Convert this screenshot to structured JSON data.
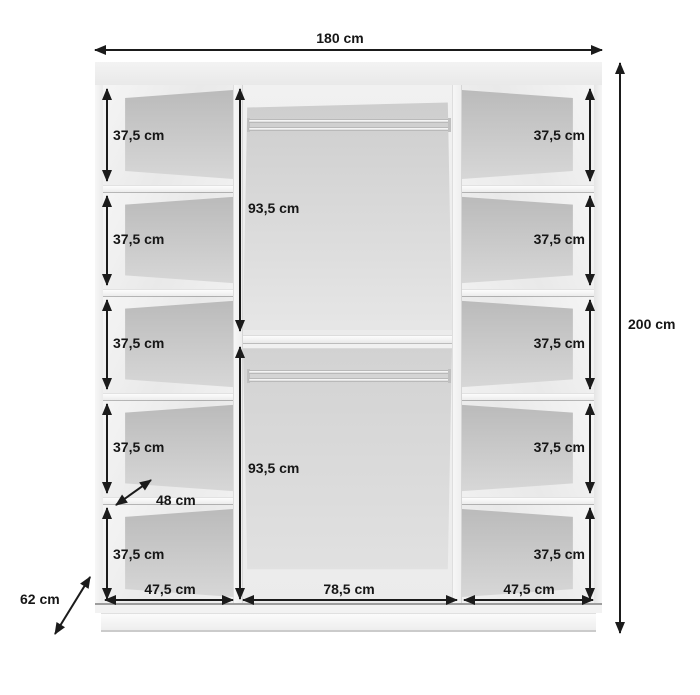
{
  "diagram": {
    "type": "furniture-dimension-drawing",
    "subject": "wardrobe interior with shelves and hanging rails",
    "unit": "cm",
    "overall": {
      "width": "180 cm",
      "height": "200 cm",
      "depth": "62 cm"
    },
    "shelf_depth": "48 cm",
    "left_column_shelves": [
      "37,5 cm",
      "37,5 cm",
      "37,5 cm",
      "37,5 cm",
      "37,5 cm"
    ],
    "right_column_shelves": [
      "37,5 cm",
      "37,5 cm",
      "37,5 cm",
      "37,5 cm",
      "37,5 cm"
    ],
    "hanging_sections": {
      "top": "93,5 cm",
      "bottom": "93,5 cm"
    },
    "section_widths": {
      "left": "47,5 cm",
      "middle": "78,5 cm",
      "right": "47,5 cm"
    }
  },
  "colors": {
    "dimension_lines": "#1b1b1b",
    "back_panel": "#c9c9c9",
    "carcass": "#f2f2f2",
    "background": "#ffffff"
  }
}
